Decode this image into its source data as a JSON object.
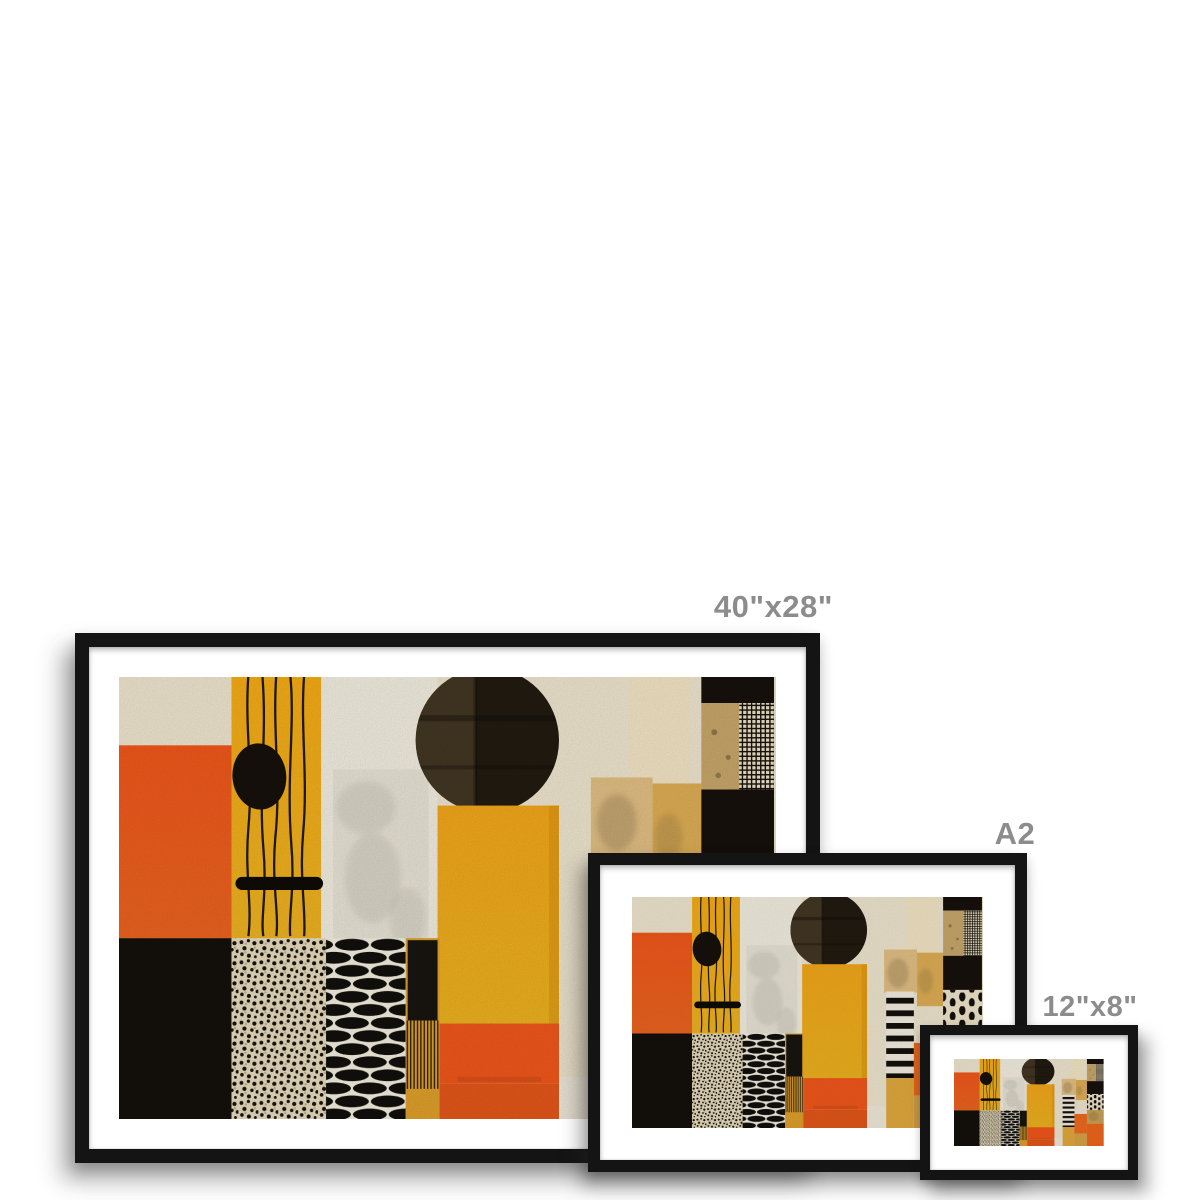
{
  "page": {
    "background_color": "#ffffff",
    "label_color": "#8c8c8c"
  },
  "product": {
    "kind": "framed print size comparison",
    "frame_color": "#141414",
    "mat_color": "#ffffff",
    "sizes": [
      {
        "id": "large",
        "label": "40\"x28\""
      },
      {
        "id": "a2",
        "label": "A2"
      },
      {
        "id": "small",
        "label": "12\"x8\""
      }
    ]
  },
  "artwork": {
    "description": "Abstract geometric mid-century collage: cream background with orange and yellow blocks, black circle, wavy black lines, leopard-dot and bean-row patterns, grid and stripe panels",
    "palette": {
      "cream": "#efe6cf",
      "white_col": "#f3eee1",
      "orange": "#f1571b",
      "burnt_orange": "#e4571a",
      "yellow": "#f5aa17",
      "amber": "#dfa02b",
      "gold": "#c9a256",
      "tan": "#e3c084",
      "ink": "#16110b"
    }
  }
}
